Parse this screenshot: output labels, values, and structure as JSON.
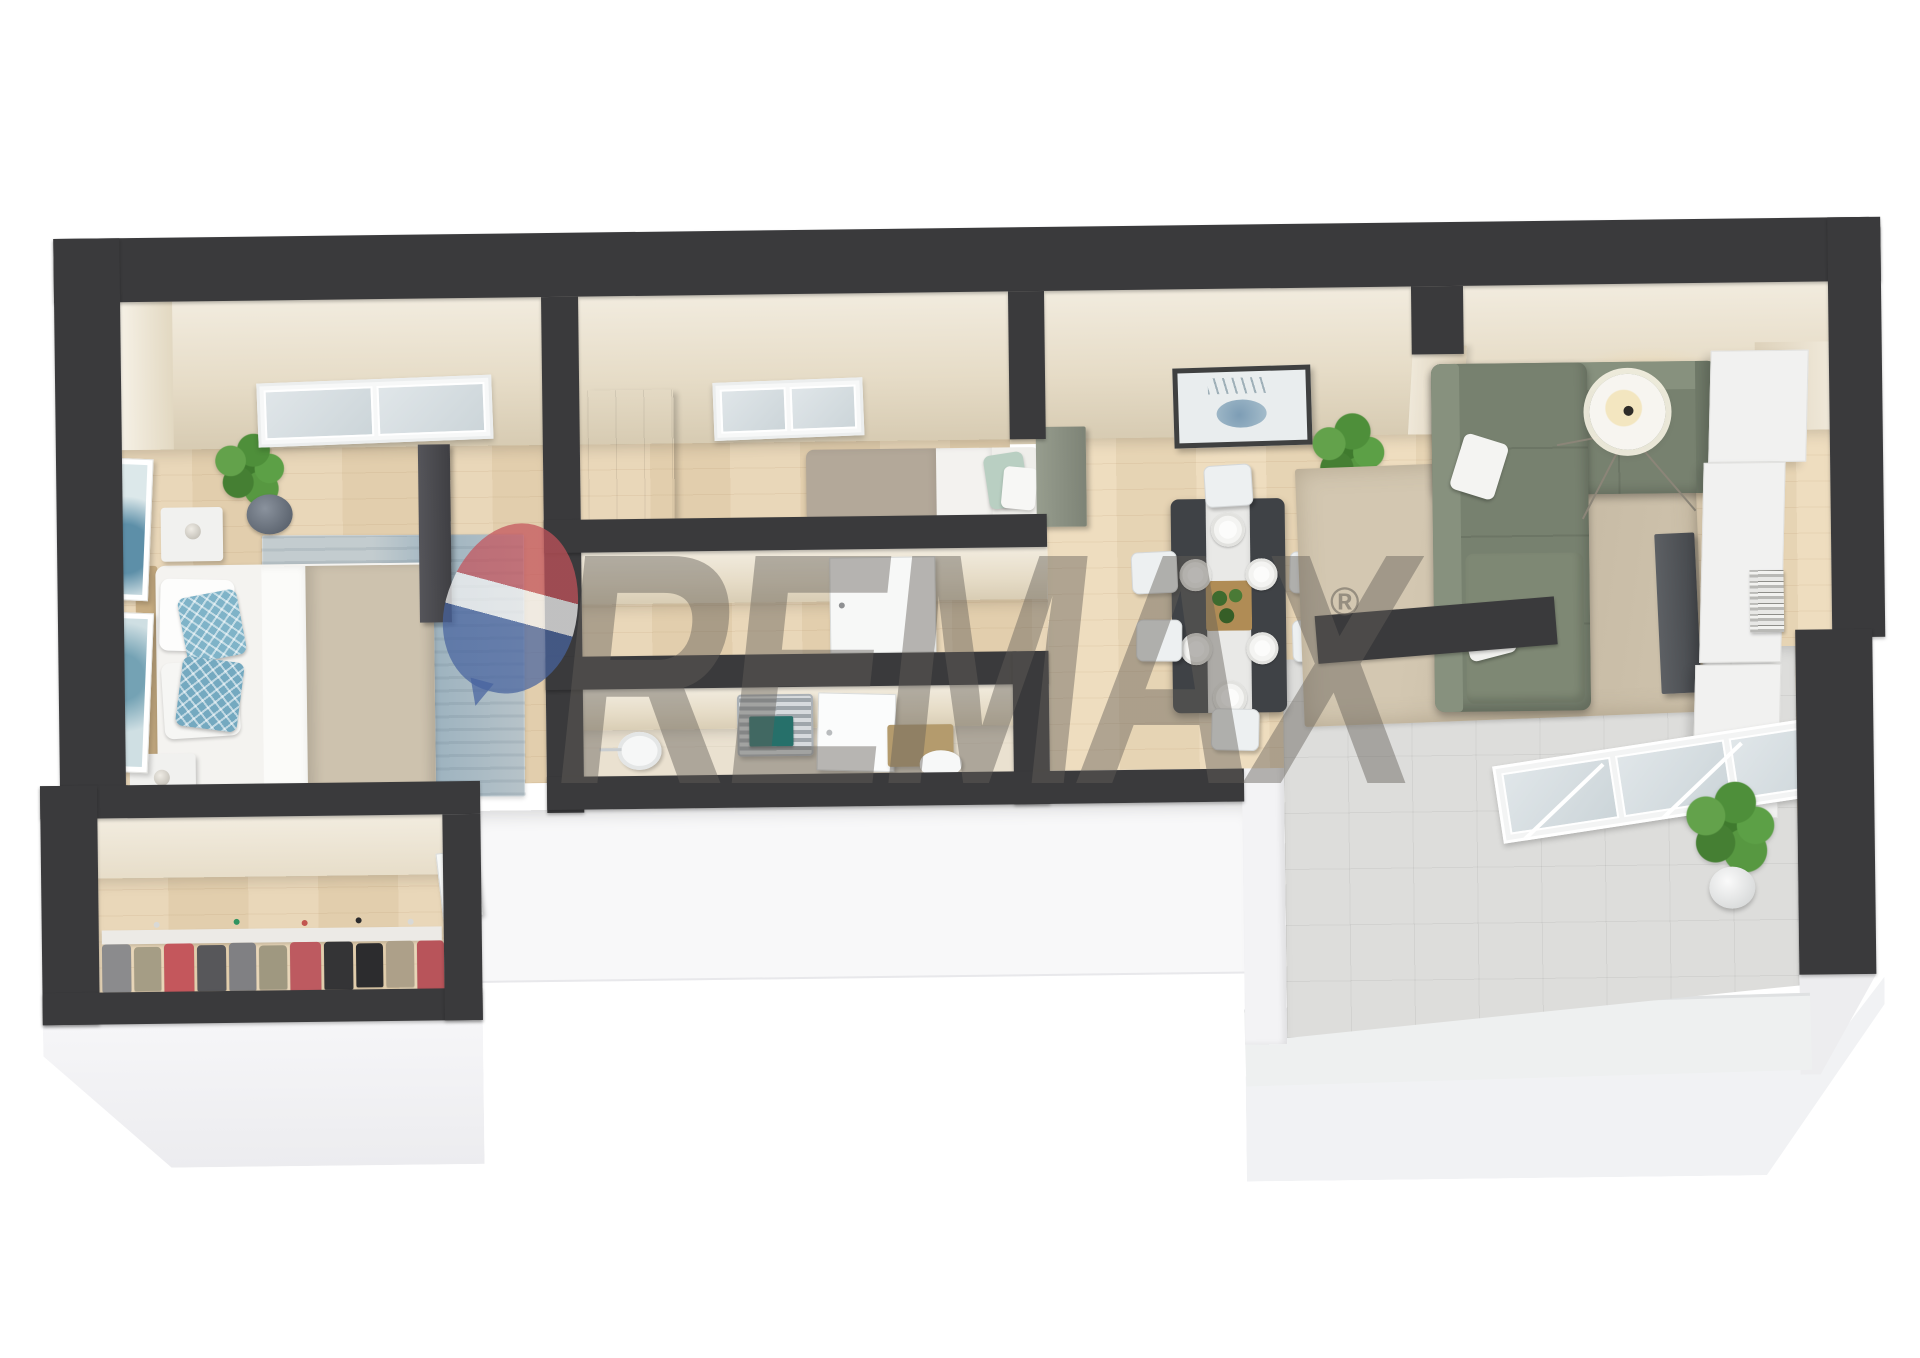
{
  "image": {
    "kind": "3d-floor-plan-render",
    "style": "isometric-top-down-apartment"
  },
  "watermark": {
    "brand_text": "REMAX",
    "registered_mark": "®",
    "balloon": {
      "top_color": "#c4525a",
      "middle_color": "#f5f5f5",
      "bottom_color": "#47639f"
    },
    "text_color": "rgba(100,95,88,0.45)"
  },
  "palette": {
    "wall_top": "#3a3a3c",
    "wall_face_cream": "#eee7d7",
    "wood_floor": "#e7d3b1",
    "bathroom_floor": "#eae1d0",
    "balcony_tile": "#dddddb",
    "building_base_white": "#f5f5f7",
    "sofa_sage_green": "#77816f",
    "bedroom_rug_blue": "#b5c0c6",
    "living_rug_beige": "#cdc1ab",
    "accent_teal_towel": "#26706a",
    "mint_pillow": "#b9cfc2",
    "blue_pillow": "#7fb3c8",
    "plant_green": "#4e8f3a"
  },
  "rooms": [
    {
      "name": "master-bedroom",
      "furniture": [
        "double-bed",
        "blue-accent-pillows",
        "blue-area-rug",
        "nightstand-top",
        "nightstand-bottom",
        "table-lamps",
        "wall-art-frames",
        "potted-plant",
        "roof-window",
        "dark-wardrobe"
      ]
    },
    {
      "name": "walk-in-closet",
      "furniture": [
        "clothes-rack",
        "hanging-clothes",
        "closet-door"
      ]
    },
    {
      "name": "bedroom-2",
      "furniture": [
        "single-bed",
        "mint-pillow",
        "wood-wardrobe",
        "roof-window"
      ]
    },
    {
      "name": "hallway",
      "furniture": [
        "white-door"
      ]
    },
    {
      "name": "bathroom",
      "furniture": [
        "towel-radiator",
        "teal-towel",
        "round-sink",
        "shower-door",
        "wood-vanity",
        "toilet"
      ]
    },
    {
      "name": "living-dining",
      "furniture": [
        "dining-table",
        "six-dining-chairs",
        "six-place-settings",
        "serving-tray",
        "deer-wall-art",
        "potted-plant",
        "sage-sectional-sofa",
        "white-throw-pillows",
        "beige-area-rug",
        "tripod-floor-lamp",
        "tv-panel",
        "media-cabinets",
        "book-stack",
        "sage-cabinet"
      ]
    },
    {
      "name": "balcony",
      "furniture": [
        "sliding-glass-door",
        "tiled-floor",
        "potted-plant"
      ]
    }
  ]
}
